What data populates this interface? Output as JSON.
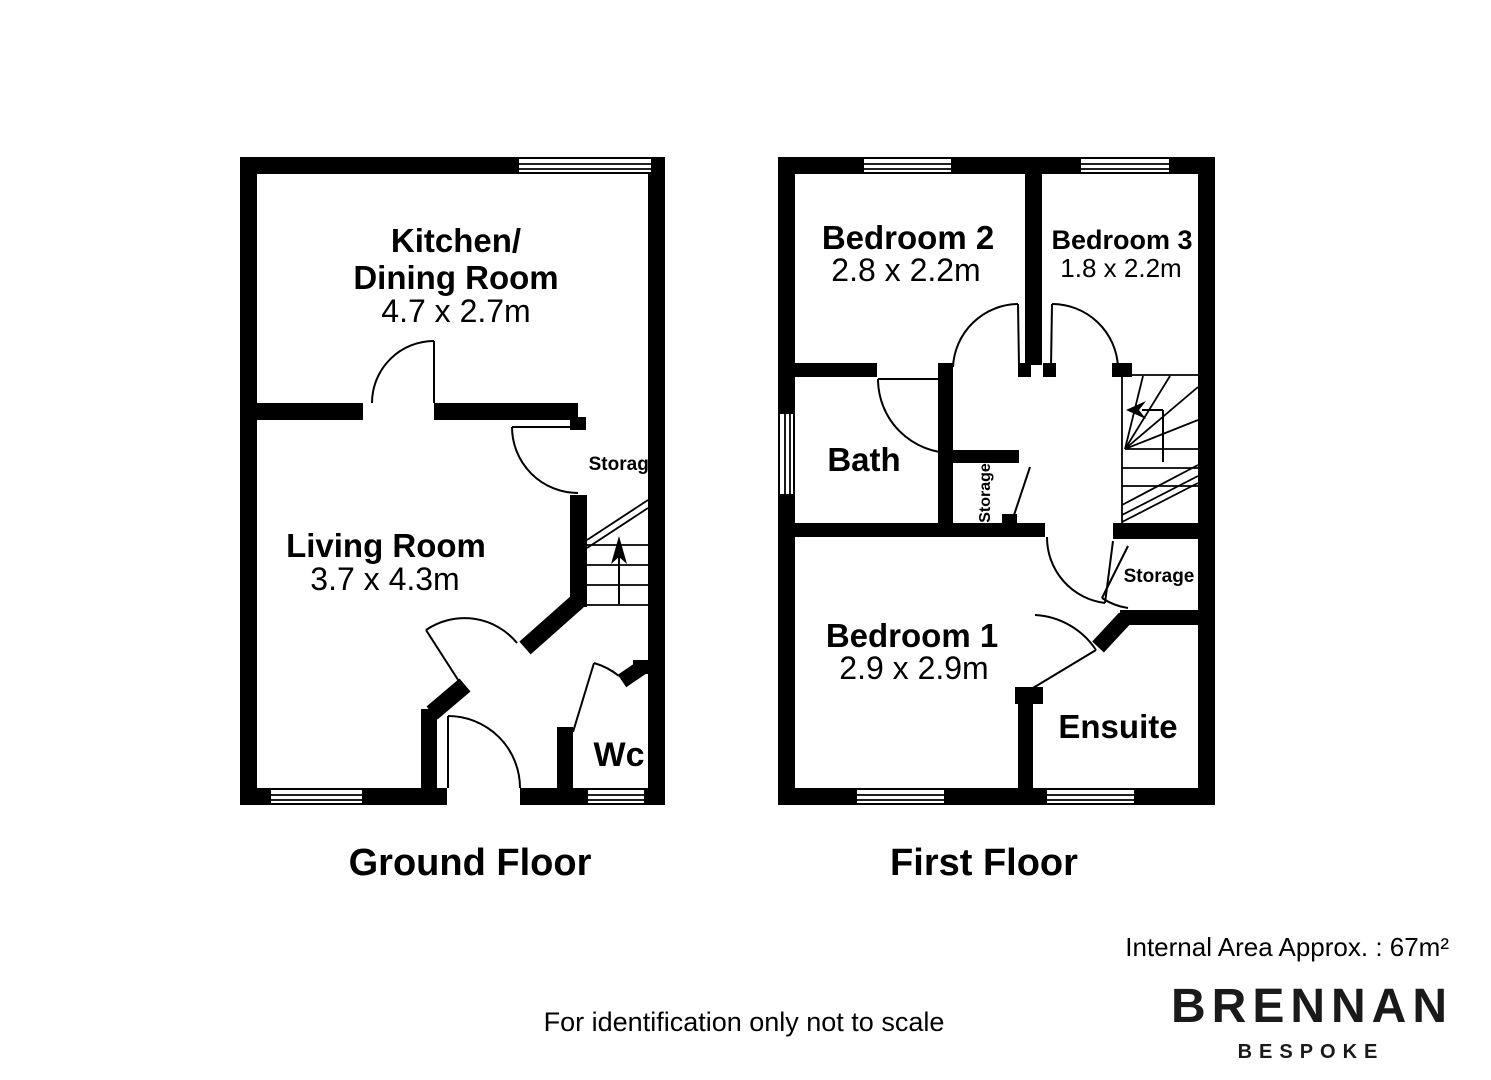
{
  "colors": {
    "ink": "#000000",
    "background": "#ffffff"
  },
  "ground_floor": {
    "title": "Ground Floor",
    "kitchen_label_line1": "Kitchen/",
    "kitchen_label_line2": "Dining Room",
    "kitchen_dimensions": "4.7 x 2.7m",
    "living_label": "Living Room",
    "living_dimensions": "3.7 x 4.3m",
    "storage_label": "Storage",
    "wc_label": "Wc"
  },
  "first_floor": {
    "title": "First Floor",
    "bedroom2_label": "Bedroom 2",
    "bedroom2_dimensions": "2.8 x 2.2m",
    "bedroom3_label": "Bedroom 3",
    "bedroom3_dimensions": "1.8 x 2.2m",
    "bath_label": "Bath",
    "landing_storage_label": "Storage",
    "stair_storage_label": "Storage",
    "bedroom1_label": "Bedroom 1",
    "bedroom1_dimensions": "2.9 x 2.9m",
    "ensuite_label": "Ensuite"
  },
  "footer": {
    "area_note": "Internal Area Approx. : 67m²",
    "disclaimer": "For identification only not to scale",
    "brand_name": "BRENNAN",
    "brand_tagline": "BESPOKE"
  }
}
